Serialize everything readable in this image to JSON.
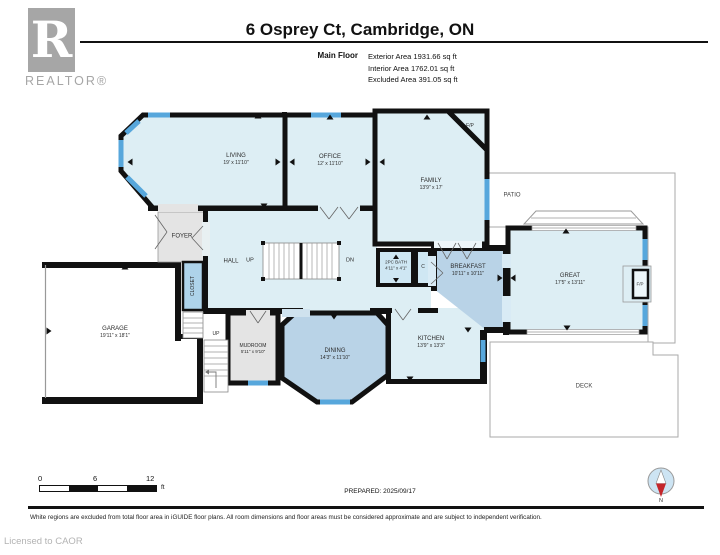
{
  "header": {
    "logo_letter": "R",
    "logo_text": "REALTOR®",
    "title": "6 Osprey Ct, Cambridge, ON",
    "floor_label": "Main Floor",
    "stats": [
      "Exterior Area 1931.66 sq ft",
      "Interior Area 1762.01 sq ft",
      "Excluded Area 391.05 sq ft"
    ]
  },
  "rooms": {
    "living": {
      "name": "LIVING",
      "dims": "19' x 11'10\""
    },
    "office": {
      "name": "OFFICE",
      "dims": "12' x 11'10\""
    },
    "family": {
      "name": "FAMILY",
      "dims": "13'9\" x 17'"
    },
    "patio": {
      "name": "PATIO"
    },
    "great": {
      "name": "GREAT",
      "dims": "17'5\" x 13'11\""
    },
    "breakfast": {
      "name": "BREAKFAST",
      "dims": "10'11\" x 10'11\""
    },
    "bath": {
      "name": "2PC BATH",
      "dims": "4'11\" x 4'1\""
    },
    "closet_c": {
      "name": "C"
    },
    "kitchen": {
      "name": "KITCHEN",
      "dims": "13'9\" x 13'3\""
    },
    "dining": {
      "name": "DINING",
      "dims": "14'3\" x 11'10\""
    },
    "mudroom": {
      "name": "MUDROOM",
      "dims": "5'11\" x 9'10\""
    },
    "hall": {
      "name": "HALL"
    },
    "foyer": {
      "name": "FOYER"
    },
    "closet": {
      "name": "CLOSET"
    },
    "garage": {
      "name": "GARAGE",
      "dims": "19'11\" x 18'1\""
    },
    "deck": {
      "name": "DECK"
    },
    "fireplace_family": {
      "name": "F/P"
    },
    "fireplace_great": {
      "name": "F/P"
    },
    "stairs": {
      "up": "UP",
      "down": "DN",
      "up2": "UP"
    }
  },
  "footer": {
    "scale_ticks": [
      "0",
      "6",
      "12"
    ],
    "scale_unit": "ft",
    "prepared": "PREPARED: 2025/09/17",
    "compass_n": "N",
    "disclaimer": "White regions are excluded from total floor area in iGUIDE floor plans. All room dimensions and floor areas must be considered approximate and are subject to independent verification.",
    "license": "Licensed to CAOR"
  },
  "colors": {
    "room_fill": "#ddeef4",
    "room_fill_dark": "#b9d3e7",
    "window_blue": "#57a7dc",
    "wall_black": "#111111",
    "excluded_gray": "#e4e4e4",
    "logo_gray": "#a6a6a6",
    "compass_red": "#c4262b",
    "compass_blue": "#cde4f3"
  },
  "icons": {
    "compass": "compass-icon",
    "logo": "realtor-logo"
  }
}
